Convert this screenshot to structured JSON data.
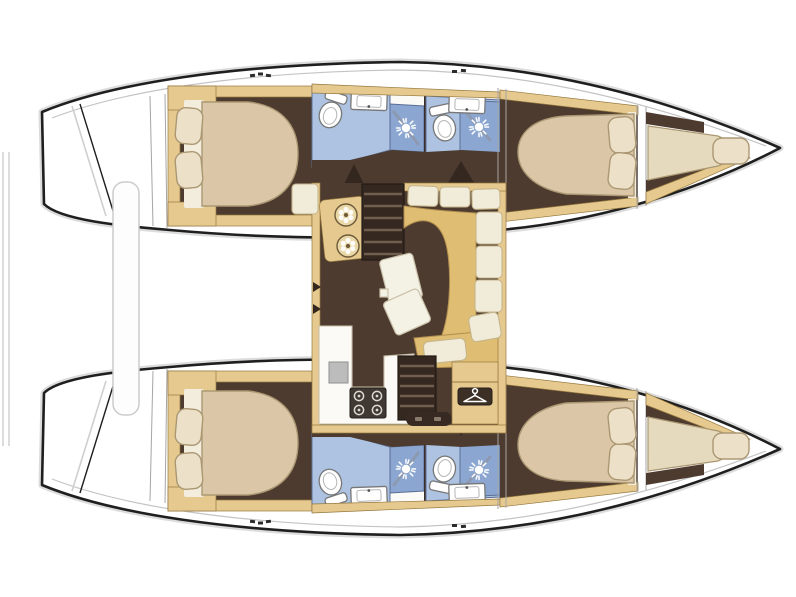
{
  "scene": {
    "description": "Top-down catamaran interior layout plan, bow pointing right: two symmetric hulls each with aft double cabin, two bathrooms (toilet, sink, shower), forward double cabin and forepeak berth; central saloon with chart table and stools, companionway stairs, L-shaped sofa, tilted table, galley with sink and four-burner stove, wardrobe with hanger symbol",
    "vessel_type": "catamaran floor plan",
    "visible_text": ""
  },
  "colors": {
    "background": "#ffffff",
    "outline": "#1f1f1f",
    "halo": "#c0c0c0",
    "deck_line": "#c4c4c4",
    "wood": "#e6c98e",
    "wood_edge": "#96793f",
    "floor": "#4d3b30",
    "floor_dark": "#362a22",
    "bed": "#dbc7a7",
    "bed_sheet": "#f3eddd",
    "berth": "#e6dabe",
    "pillow": "#ece1c8",
    "pillow_edge": "#ab9873",
    "bath_floor": "#adc3e1",
    "bath_shower": "#8ba7d1",
    "bath_edge": "#5b6f96",
    "fixture": "#ffffff",
    "fixture_edge": "#777777",
    "counter": "#fbfaf6",
    "sofa_seat": "#dfbd72",
    "sofa_edge": "#b08d4e",
    "cushion": "#f1ebd9",
    "cushion_edge": "#c6b68c",
    "table_top": "#f4f1e5",
    "table_edge": "#c9c0a8",
    "stove_body": "#3f3833",
    "burner_ring": "#ddd9d3",
    "sink_steel": "#bcbcbc",
    "stool": "#ead7a6",
    "stool_edge": "#6d5a3a",
    "plaque": "#3b2f26",
    "stairs": "#352821",
    "stair_step": "#6f5d4e",
    "door_wedge": "#33271f",
    "cockpit_bar": "#fdfdfd",
    "cockpit_bar_edge": "#cccccc",
    "rail": "#8d99b0"
  },
  "icons": {
    "shower_head": "sunburst",
    "hanger": "clothes-hanger",
    "stove_burners": "four-rings",
    "stool_top": "flower-rosette",
    "toilet": "oval-bowl-with-tank",
    "sink": "rect-basin-with-drain-dot"
  }
}
